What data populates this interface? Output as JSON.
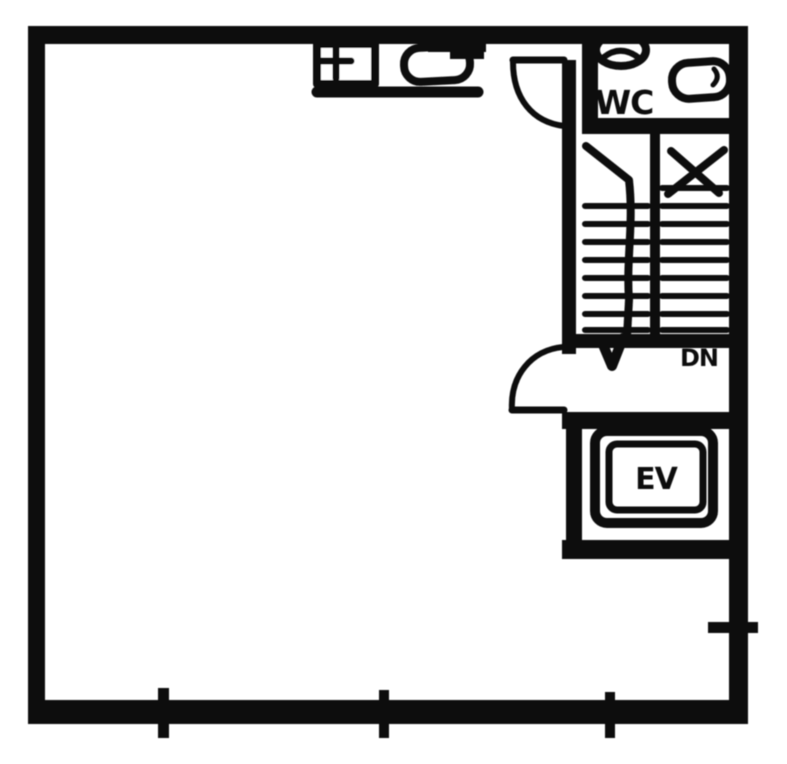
{
  "floor_plan": {
    "labels": {
      "wc": "WC",
      "elevator": "EV",
      "stair_direction": "DN"
    },
    "colors": {
      "ink": "#101010",
      "paper": "#ffffff"
    },
    "fixtures": [
      "toilet-icon",
      "wash-basin-icon",
      "sink-counter-icon",
      "staircase",
      "stair-direction-arrow",
      "elevator-shaft",
      "door-swing",
      "wall-tick"
    ]
  }
}
